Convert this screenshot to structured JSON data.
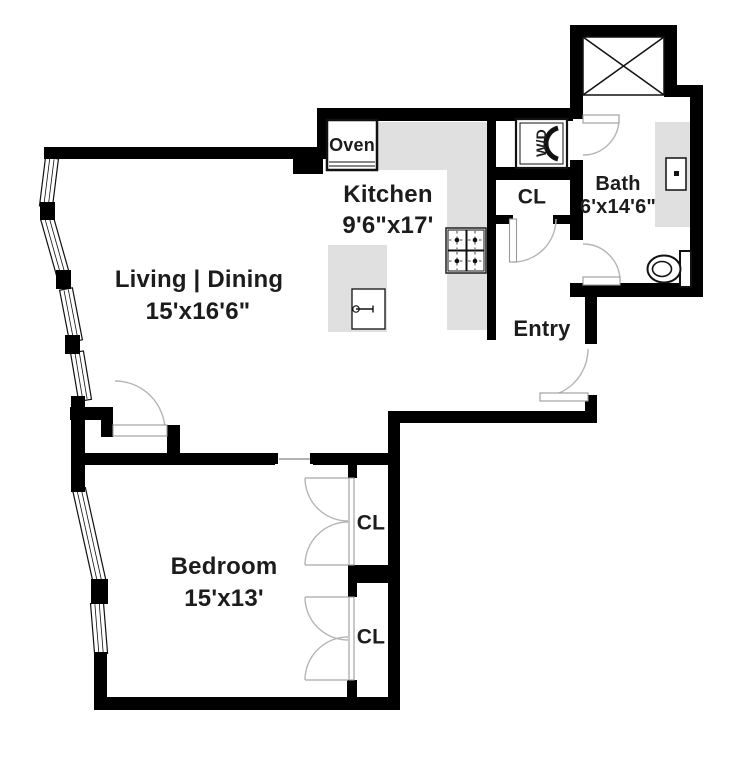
{
  "plan": {
    "living": {
      "name": "Living | Dining",
      "dims": "15'x16'6\""
    },
    "kitchen": {
      "name": "Kitchen",
      "dims": "9'6\"x17'"
    },
    "bath": {
      "name": "Bath",
      "dims": "6'x14'6\""
    },
    "bedroom": {
      "name": "Bedroom",
      "dims": "15'x13'"
    },
    "entry": {
      "name": "Entry"
    },
    "closet_entry": {
      "label": "CL"
    },
    "closet_bedroom_top": {
      "label": "CL"
    },
    "closet_bedroom_bottom": {
      "label": "CL"
    },
    "oven": {
      "label": "Oven"
    },
    "washer_dryer": {
      "label": "W/D"
    }
  },
  "colors": {
    "wall": "#000000",
    "counter": "#e0e0e0",
    "door_arc": "#b5b5b5",
    "text": "#1c1c1c",
    "background": "#ffffff"
  }
}
